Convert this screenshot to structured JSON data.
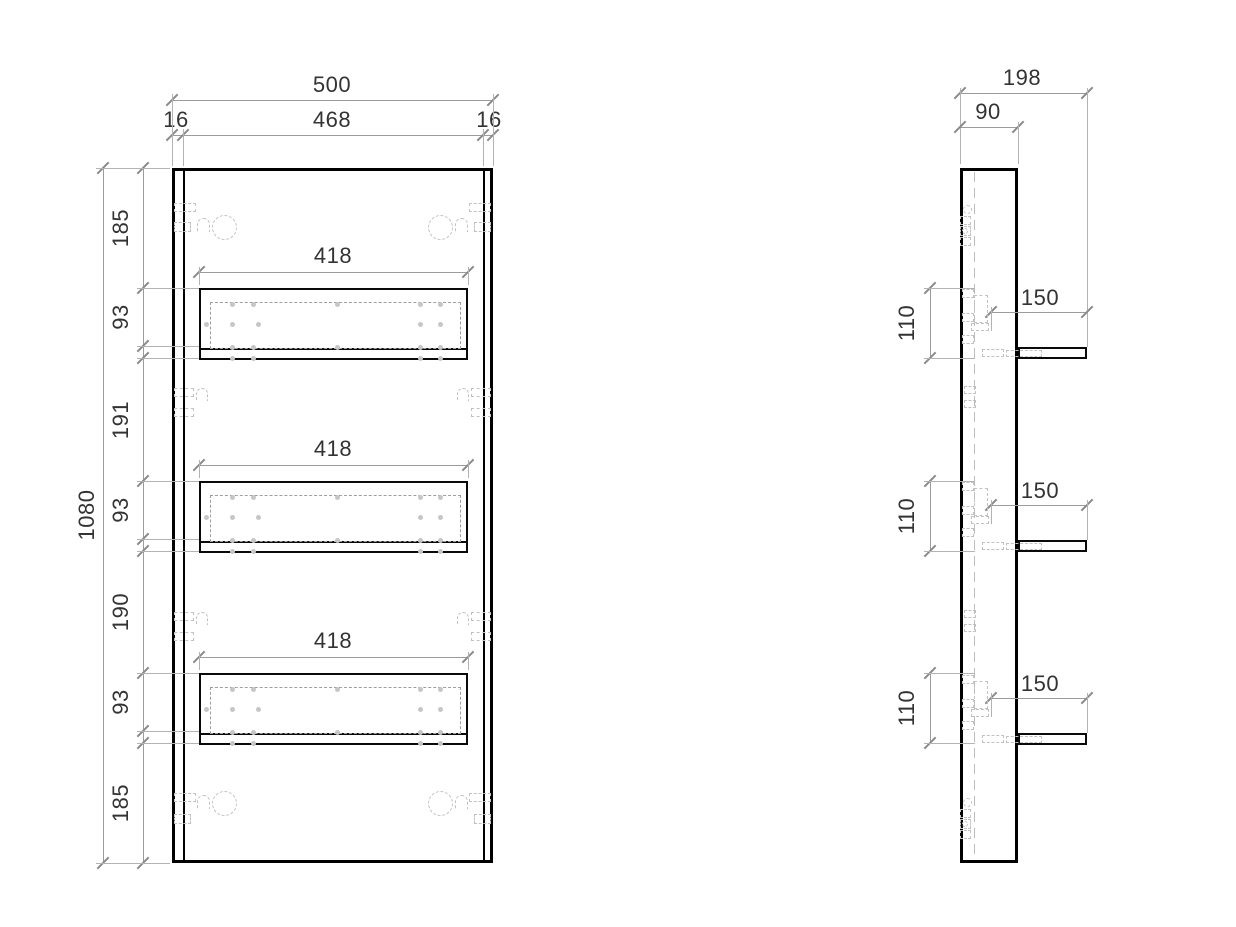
{
  "drawing": {
    "front_view": {
      "overall_width": "500",
      "inner_width": "468",
      "left_thickness": "16",
      "right_thickness": "16",
      "overall_height": "1080",
      "shelf_lengths": [
        "418",
        "418",
        "418"
      ],
      "height_segments": [
        "185",
        "93",
        "191",
        "93",
        "190",
        "93",
        "185"
      ]
    },
    "side_view": {
      "overall_depth": "198",
      "panel_depth": "90",
      "shelf_depths": [
        "150",
        "150",
        "150"
      ],
      "shelf_module_heights": [
        "110",
        "110",
        "110"
      ]
    },
    "style": {
      "outline_color": "#000000",
      "dimension_line_color": "#9c9c9c",
      "hidden_detail_color": "#c2c2c2",
      "text_color": "#333333",
      "background_color": "#ffffff"
    }
  }
}
